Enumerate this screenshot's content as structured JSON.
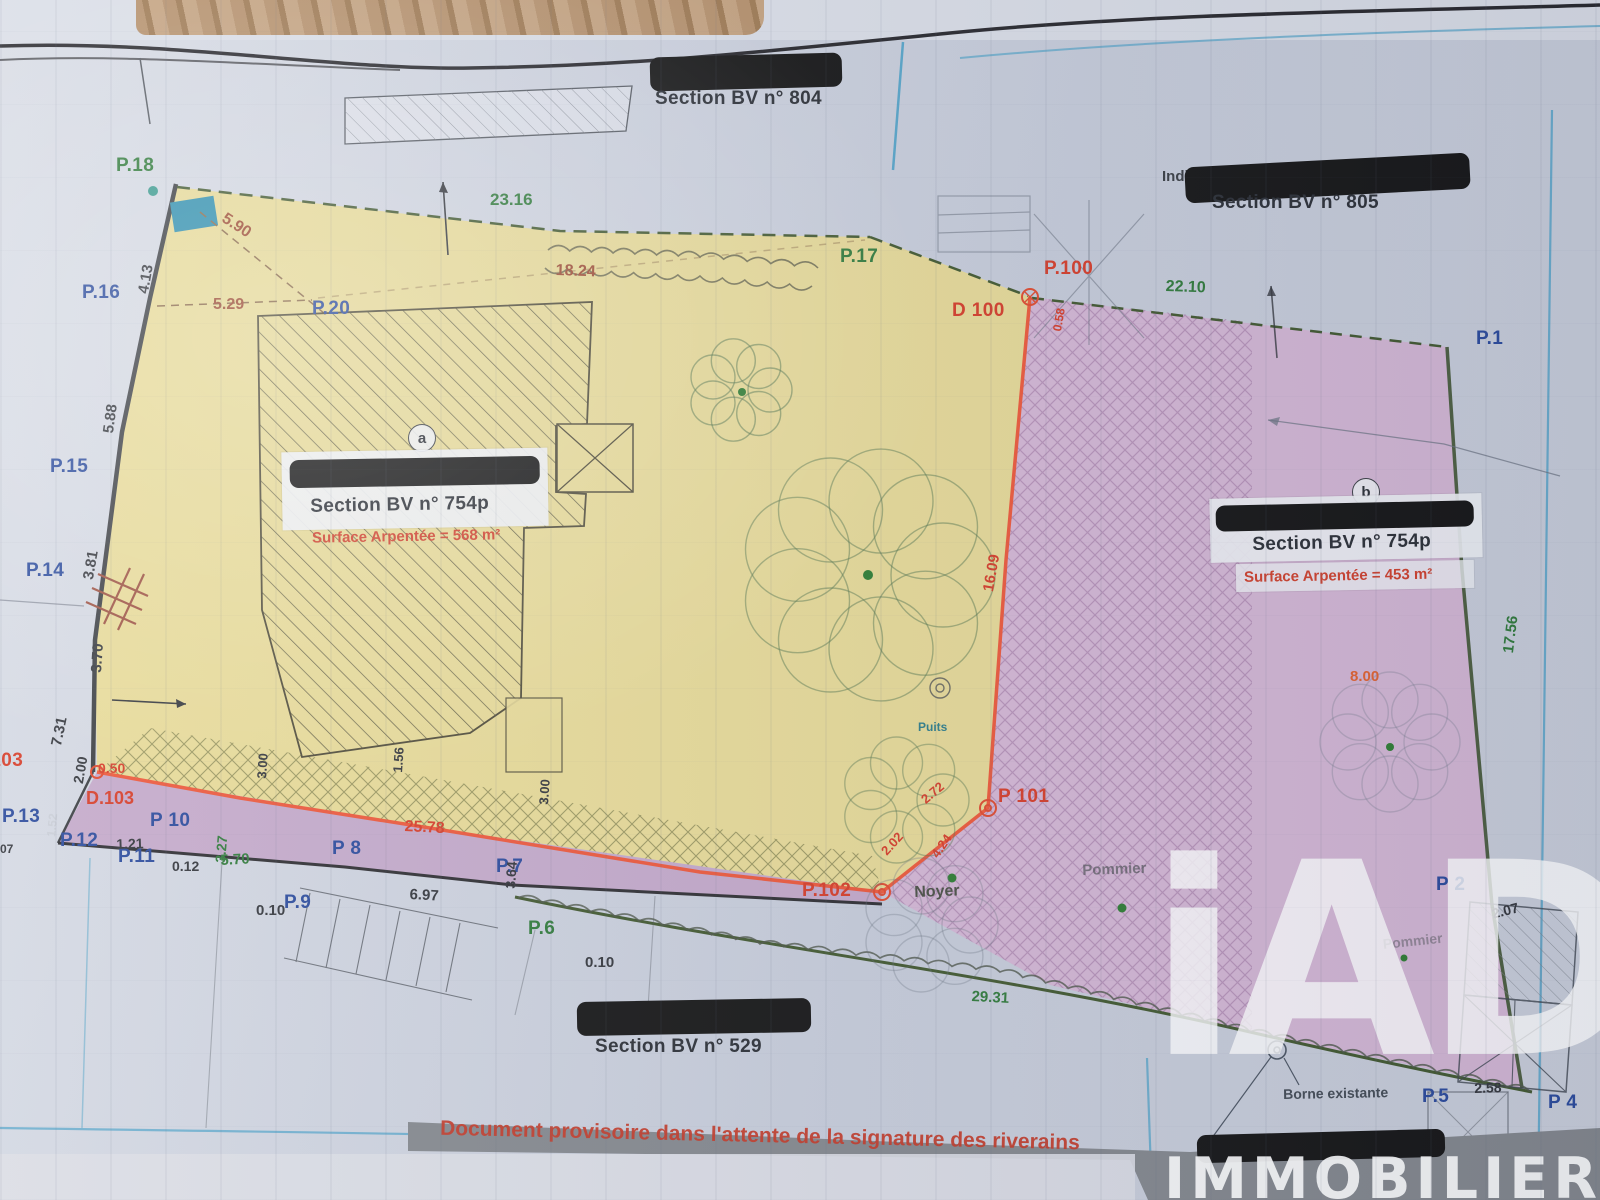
{
  "sections": {
    "bv804": "Section BV n° 804",
    "bv805": "Section BV n° 805",
    "bv805_hidden": "Indivision",
    "bv529": "Section BV n° 529"
  },
  "parcels": {
    "a": {
      "marker": "a",
      "section": "Section BV n° 754p",
      "surface": "Surface Arpentée = 568 m²"
    },
    "b": {
      "marker": "b",
      "section": "Section BV n° 754p",
      "surface": "Surface Arpentée = 453 m²"
    }
  },
  "points": {
    "p1": "P.1",
    "p2": "P 2",
    "p4": "P 4",
    "p5": "P.5",
    "p6": "P.6",
    "p7": "P.7",
    "p8": "P 8",
    "p9": "P.9",
    "p10": "P 10",
    "p11": "P.11",
    "p12": "P.12",
    "p13": "P.13",
    "p14": "P.14",
    "p15": "P.15",
    "p16": "P.16",
    "p17": "P.17",
    "p18": "P.18",
    "p20": "P.20",
    "p100": "P.100",
    "p101": "P 101",
    "p102": "P.102",
    "d100": "D 100",
    "d103": "D.103",
    "p103": "P.103"
  },
  "measurements": {
    "m23_16": "23.16",
    "m18_24": "18.24",
    "m5_90": "5.90",
    "m5_29": "5.29",
    "m4_13": "4.13",
    "m5_88": "5.88",
    "m3_81": "3.81",
    "m3_70": "3.70",
    "m7_31": "7.31",
    "m2_00": "2.00",
    "m1_52": "1.52",
    "m0_50": "0.50",
    "m1_21": "1.21",
    "m0_12": "0.12",
    "m5_70": "5.70",
    "m3_27": "3.27",
    "m0_10a": "0.10",
    "m6_97": "6.97",
    "m3_64": "3.64",
    "m25_78": "25.78",
    "m1_56": "1.56",
    "m3_00a": "3.00",
    "m3_00b": "3.00",
    "m0_10b": "0.10",
    "m16_09": "16.09",
    "m22_10": "22.10",
    "m17_56": "17.56",
    "m8_00": "8.00",
    "m29_31": "29.31",
    "m2_72": "2.72",
    "m2_02": "2.02",
    "m4_24": "4.24",
    "m0_58": "0.58",
    "m2_07": "2.07",
    "m2_58": "2.58",
    "m07": "07"
  },
  "annotations": {
    "puits": "Puits",
    "noyer": "Noyer",
    "pommier1": "Pommier",
    "pommier2": "Pommier",
    "borne": "Borne existante",
    "footer": "Document provisoire dans l'attente de la signature des riverains"
  },
  "watermark": {
    "logo": "iAD",
    "brand": "IMMOBILIER"
  },
  "colors": {
    "parcel_a_fill": "#e7da97",
    "parcel_b_fill": "#d5b5d5",
    "strip_fill": "#c2a5c8",
    "boundary_orange": "#ee5233",
    "boundary_green": "#41582f",
    "label_blue": "#2a4a9c",
    "label_green": "#2f7a3a",
    "label_red": "#d63c28",
    "surface_red": "#d0402c",
    "watermark_white": "#ffffff"
  }
}
